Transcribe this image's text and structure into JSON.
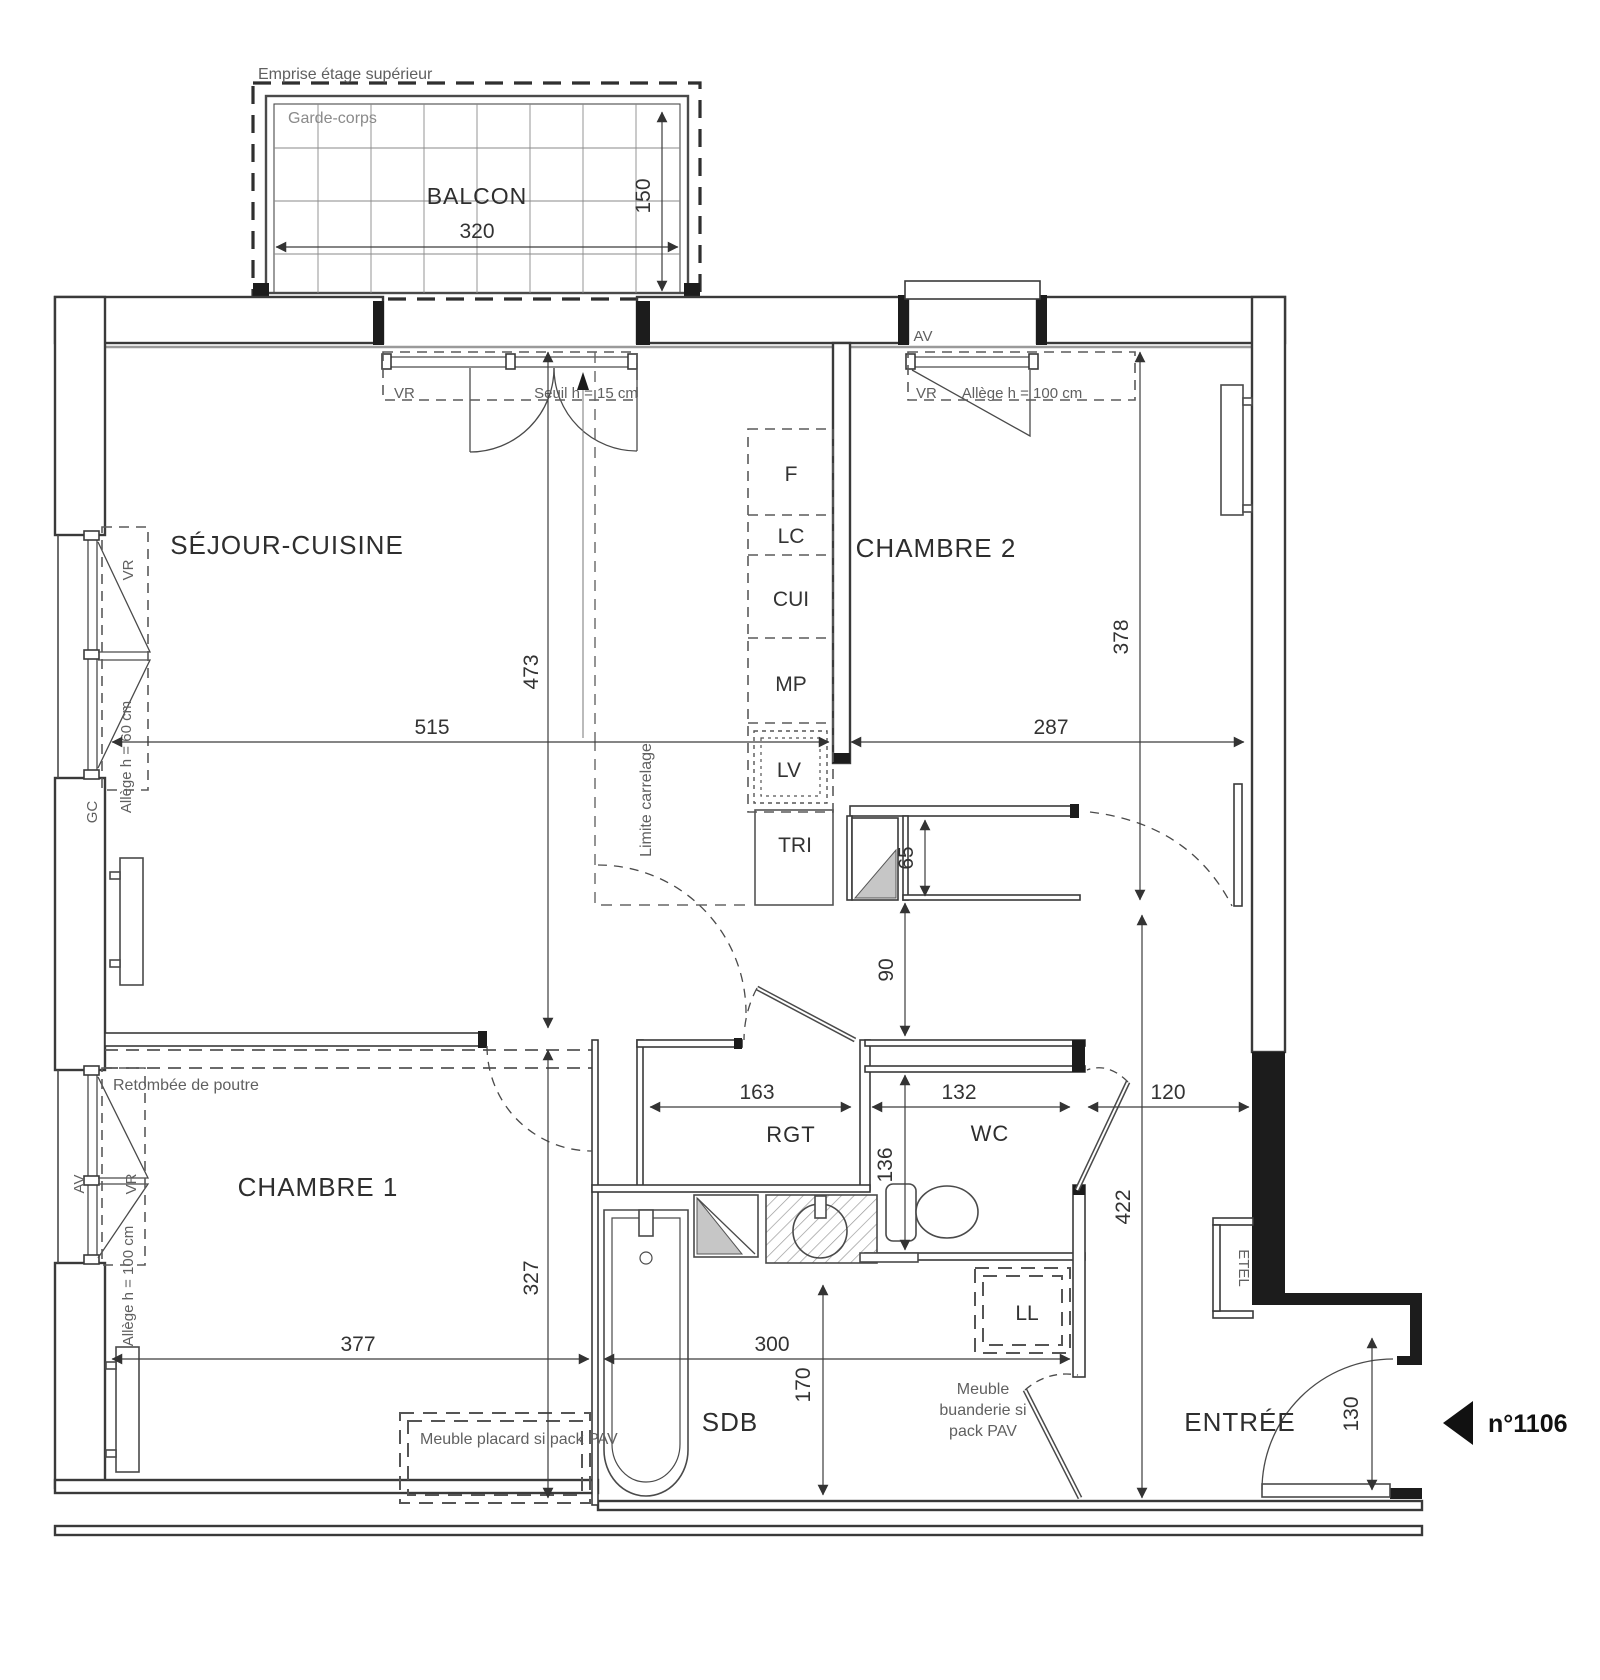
{
  "unit": {
    "number": "n°1106"
  },
  "rooms": {
    "balcon": "BALCON",
    "sejour_cuisine": "SÉJOUR-CUISINE",
    "chambre2": "CHAMBRE 2",
    "chambre1": "CHAMBRE 1",
    "rangement": "RGT",
    "wc": "WC",
    "salle_de_bains": "SDB",
    "entree": "ENTRÉE"
  },
  "kitchen": {
    "frigo": "F",
    "lave_colonne": "LC",
    "cuisson": "CUI",
    "meuble_prep": "MP",
    "lave_vaisselle": "LV",
    "tri": "TRI"
  },
  "equipment": {
    "lave_linge": "LL",
    "etel": "ETEL"
  },
  "window_labels": {
    "vr": "VR",
    "av": "AV",
    "gc": "GC",
    "seuil": "Seuil h = 15 cm",
    "allege_100": "Allège h = 100 cm",
    "allege_60": "Allège h = 60 cm"
  },
  "annotations": {
    "emprise": "Emprise étage supérieur",
    "garde_corps": "Garde-corps",
    "retombee_poutre": "Retombée de poutre",
    "limite_carrelage": "Limite carrelage",
    "meuble_placard": "Meuble placard si pack PAV",
    "meuble_buanderie_l1": "Meuble",
    "meuble_buanderie_l2": "buanderie si",
    "meuble_buanderie_l3": "pack PAV"
  },
  "dimensions": {
    "balcon_largeur": "320",
    "balcon_profondeur": "150",
    "sejour_largeur": "515",
    "sejour_profondeur": "473",
    "chambre2_largeur": "287",
    "chambre2_profondeur": "378",
    "placard_ch2": "65",
    "degagement_ch2": "90",
    "rangement_largeur": "163",
    "wc_largeur": "132",
    "degagement_largeur": "120",
    "wc_profondeur": "136",
    "entree_profondeur": "422",
    "chambre1_largeur": "377",
    "chambre1_profondeur": "327",
    "sdb_largeur": "300",
    "sdb_profondeur": "170",
    "porte_entree": "130"
  }
}
